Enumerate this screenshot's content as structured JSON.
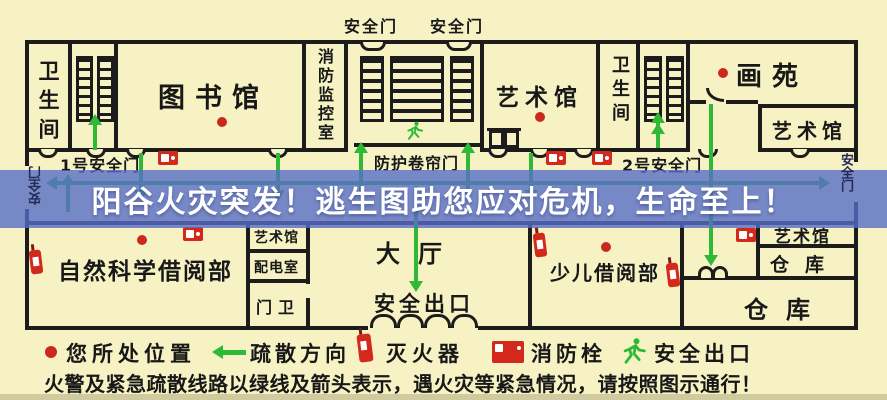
{
  "banner": {
    "text": "阳谷火灾突发！逃生图助您应对危机，生命至上！"
  },
  "plan": {
    "rooms": {
      "wc_left": "卫生间",
      "library": "图书馆",
      "fire_monitor": "消防监控室",
      "reading_room_door_a": "安全门",
      "reading_room_door_b": "安全门",
      "art_center": "艺术馆",
      "wc_right": "卫生间",
      "painting_garden": "画苑",
      "art_top_right": "艺术馆",
      "natural_science": "自然科学借阅部",
      "art_small": "艺术馆",
      "power_room": "配电室",
      "guard_room": "门卫",
      "hall": "大厅",
      "hall_exit": "安全出口",
      "children_reading": "少儿借阅部",
      "art_bottom_right": "艺术馆",
      "warehouse_small": "仓库",
      "warehouse_large": "仓库"
    },
    "corridor": {
      "door1": "1号安全门",
      "shutter": "防护卷帘门",
      "door2": "2号安全门",
      "exit_left": "安全门",
      "exit_right": "安全门"
    }
  },
  "legend": {
    "location": "您所处位置",
    "direction": "疏散方向",
    "extinguisher": "灭火器",
    "hydrant": "消防栓",
    "exit": "安全出口",
    "note": "火警及紧急疏散线路以绿线及箭头表示，遇火灾等紧急情况，请按照图示通行！"
  },
  "icons": {
    "red_dot": "your-location-dot",
    "green_arrow": "evacuation-direction-arrow",
    "extinguisher": "fire-extinguisher-icon",
    "hydrant": "fire-hydrant-icon",
    "running_man": "emergency-exit-runner-icon"
  },
  "colors": {
    "background": "#f6f2c4",
    "wall": "#1c1c1c",
    "banner": "#586dc7",
    "banner_text": "#ffffff",
    "arrow_green": "#2fb937",
    "marker_red": "#c92a1c"
  }
}
